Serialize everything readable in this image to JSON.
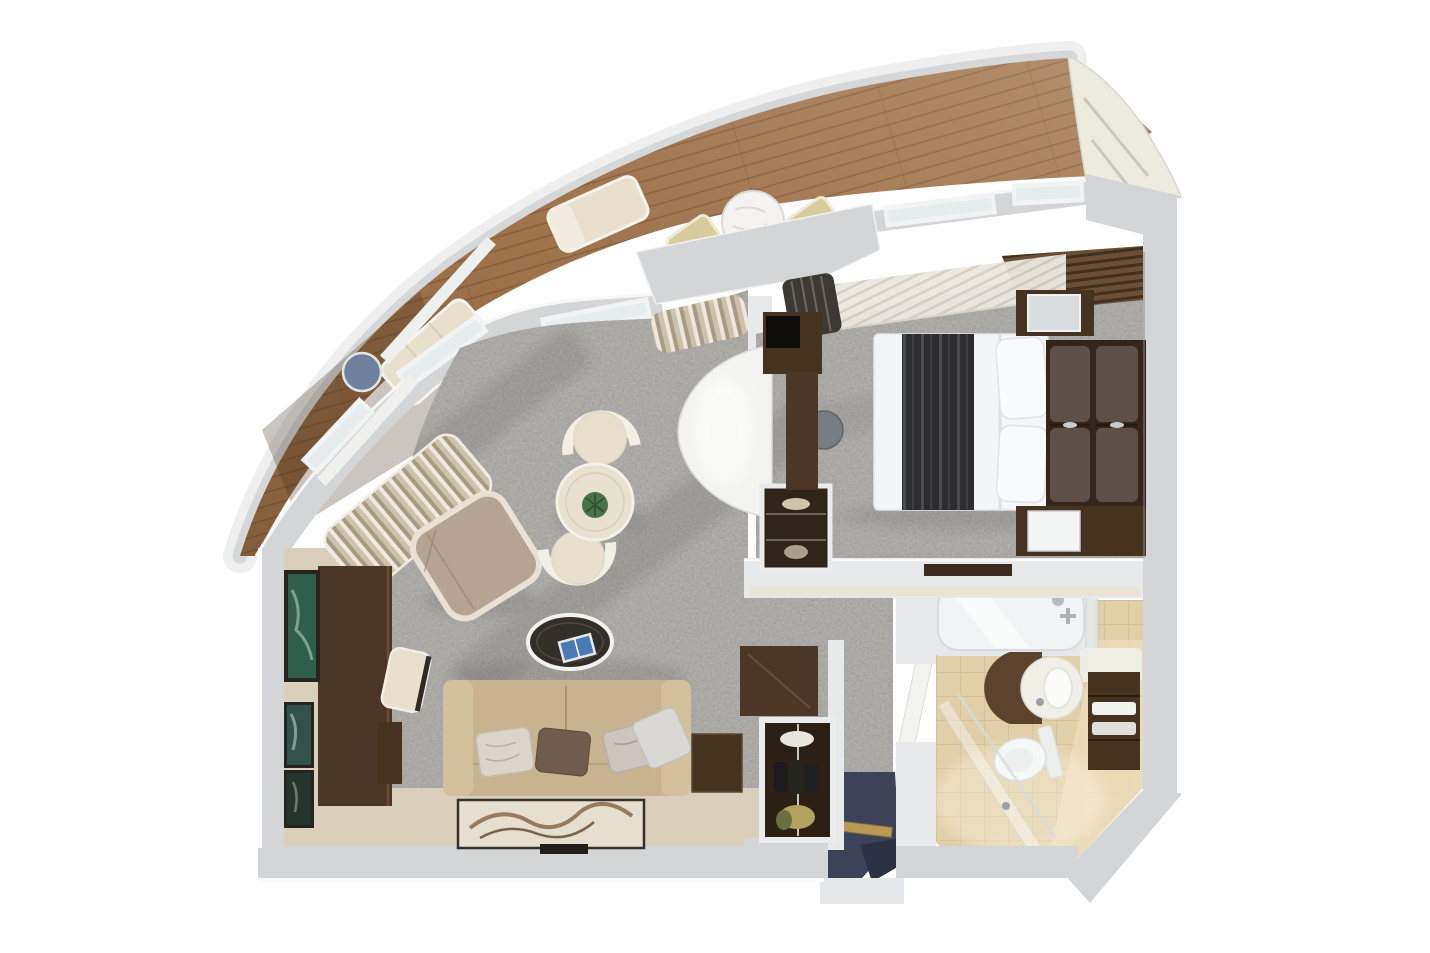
{
  "scene": {
    "kind": "3d-floor-plan-render",
    "rooms": [
      {
        "name": "balcony",
        "furniture": [
          "chaise-lounger",
          "chaise-lounger",
          "round-side-table",
          "round-dining-table",
          "deck-chair",
          "deck-chair"
        ]
      },
      {
        "name": "living-room",
        "furniture": [
          "gathered-curtain",
          "gathered-curtain",
          "wall-art",
          "wall-art",
          "wall-art",
          "desk",
          "desk-chair",
          "desk-cabinet",
          "armchair",
          "lounge-chair",
          "lounge-chair",
          "round-table-with-plant",
          "oval-coffee-table",
          "magazine",
          "three-seat-sofa",
          "throw-pillows",
          "artwork-console",
          "side-table",
          "writing-desk",
          "curved-cabinet",
          "display-cabinet",
          "bar-cabinet"
        ]
      },
      {
        "name": "bedroom",
        "furniture": [
          "sheer-curtains",
          "blackout-curtain",
          "louvered-wardrobe",
          "mirrored-cabinet",
          "double-bed",
          "bed-runner",
          "bed-pillows",
          "upholstered-headboard",
          "vanity-desk",
          "stool",
          "tv-console",
          "tv"
        ]
      },
      {
        "name": "bathroom",
        "furniture": [
          "bathtub",
          "tub-faucet",
          "glass-screen",
          "round-vanity-sink",
          "toilet",
          "towel-shelves",
          "shower-glass",
          "bathroom-door",
          "wall-ledge"
        ]
      },
      {
        "name": "entry-hall",
        "furniture": [
          "entrance-door",
          "door-threshold",
          "entry-step"
        ]
      }
    ]
  },
  "colors": {
    "background": "#ffffff",
    "hull": "#d6d7d9",
    "hull_halo": "#efeff0",
    "wall": "#d4d5d7",
    "wall_light": "#e8e9eb",
    "wood": "#a57950",
    "carpet": "#9d9c98",
    "floor_beige": "#d9cfba",
    "entry_navy": "#3c4358",
    "gold_sill": "#b99a55",
    "tile": "#e0cfa8",
    "tile_light": "#ecdcba",
    "tub_white": "#f1f3f4",
    "glass": "#e7ecee",
    "sofa": "#c8b390",
    "sofa_arm": "#d3c09c",
    "armchair": "#b5a493",
    "chair_cream": "#e8dfcc",
    "chair_beige": "#d8cb9c",
    "table_cream": "#e9e1cf",
    "plant_green": "#4c7247",
    "coffee_table_dark": "#322e29",
    "dark_wood": "#46331f",
    "desk_wood": "#4c3726",
    "wardrobe_wood": "#6b4f35",
    "bed_white": "#f3f5f6",
    "bed_runner": "#2d2d2f",
    "pillow_brown": "#6e5c4d",
    "headboard_brown": "#5e5047",
    "curtain_dark": "#3c3833",
    "counter_white": "#f1efe8",
    "toilet_white": "#f6f7f7",
    "towel_white": "#f2f2ef",
    "tv_white": "#f4f5f5",
    "stool_gray": "#767d83",
    "blue_table": "#6e82a0",
    "vanity_wood": "#5b432c",
    "art_teal": "#2f5f4c",
    "magazine_blue": "#4a7ab5"
  }
}
